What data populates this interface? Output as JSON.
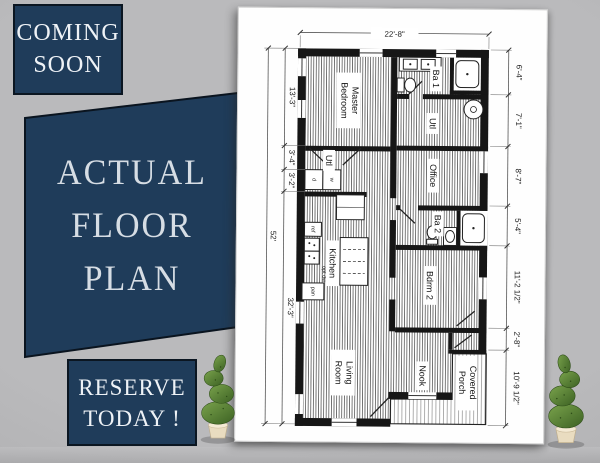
{
  "colors": {
    "navy": "#1f3c5a",
    "navy_border": "#0b1621",
    "background_gray": "#b2b2b4",
    "paper_white": "#fefefe",
    "plan_ink": "#161616",
    "tree_green": "#4e7a2e",
    "pot_cream": "#e9dcc0"
  },
  "badges": {
    "coming_soon": {
      "line1": "COMING",
      "line2": "SOON"
    },
    "headline": {
      "line1": "ACTUAL",
      "line2": "FLOOR",
      "line3": "PLAN"
    },
    "reserve": {
      "line1": "RESERVE",
      "line2": "TODAY !"
    }
  },
  "plan": {
    "dimensions": {
      "top": "22'-8\"",
      "left_total": "52'",
      "left": [
        "13'-3\"",
        "3'-4\"",
        "3'-2\"",
        "32'-3\""
      ],
      "right": [
        "6'-4\"",
        "7'-1\"",
        "8'-7\"",
        "5'-4\"",
        "11'-2 1/2\"",
        "2'-8\"",
        "10'-9 1/2\""
      ]
    },
    "rooms": {
      "master": [
        "Master",
        "Bedroom"
      ],
      "ba1": "Ba 1",
      "utl_right": "Utl",
      "utl_left": "Utl",
      "office": "Office",
      "ba2": "Ba 2",
      "bdrm2": "Bdrm 2",
      "kitchen": "Kitchen",
      "living": [
        "Living",
        "Room"
      ],
      "nook": "Nook",
      "porch": [
        "Covered",
        "Porch"
      ]
    },
    "labels": {
      "ref": "ref",
      "opt_dw": "opt dw",
      "pan": "pan",
      "dryer": "d",
      "washer": "w"
    }
  }
}
